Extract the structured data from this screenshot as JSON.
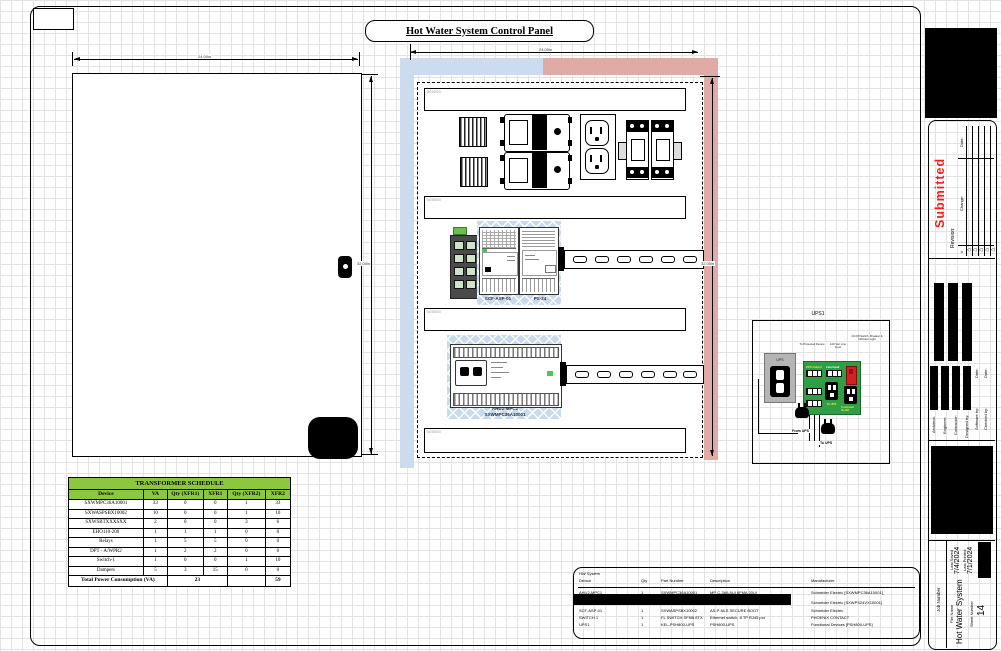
{
  "page_title": "Hot Water System Control Panel",
  "dimensions": {
    "door_width": "24.00in",
    "door_height": "32.00in",
    "panel_width": "24.00in",
    "panel_height": "32.00in"
  },
  "wireway_label": "000000",
  "backplane": {
    "scf_label": "SCF-ASP-01",
    "ps_label": "PS-24",
    "controller_name": "AHU2-MPC1",
    "controller_part": "SXWMPC36A10001"
  },
  "ups_detail": {
    "title": "UPS1",
    "ups_label": "UPS",
    "note_protected": "To Protected Device",
    "note_line": "120 Vac Line Input",
    "note_switch": "On/Off Switch, Breaker & Indicator Light",
    "board": {
      "ups_output": "UPS Output",
      "line_input": "Line Input",
      "to_ups_outlet": "To UPS",
      "computer_outlet": "Computer Outlet"
    },
    "cord_from_ups": "From UPS",
    "cord_to_ups": "To UPS"
  },
  "transformer_schedule": {
    "title": "TRANSFORMER SCHEDULE",
    "columns": [
      "Device",
      "VA",
      "Qty (XFR1)",
      "XFR1",
      "Qty (XFR2)",
      "XFR2"
    ],
    "rows": [
      [
        "SXWMPC36A10001",
        "33",
        "0",
        "0",
        "1",
        "33"
      ],
      [
        "SXWASPSBX10002",
        "10",
        "0",
        "0",
        "1",
        "10"
      ],
      [
        "SXWSBTXXXSXX",
        "2",
        "0",
        "0",
        "3",
        "6"
      ],
      [
        "EHO110-200",
        "1",
        "1",
        "1",
        "0",
        "0"
      ],
      [
        "Relays",
        "1",
        "5",
        "5",
        "0",
        "0"
      ],
      [
        "DPT - A/WPR2",
        "1",
        "2",
        "2",
        "0",
        "0"
      ],
      [
        "Switch-1",
        "1",
        "0",
        "0",
        "1",
        "10"
      ],
      [
        "Dampers",
        "5",
        "3",
        "15",
        "0",
        "0"
      ]
    ],
    "total_label": "Total Power Consumption (VA)",
    "total_xfr1": "23",
    "total_xfr2": "59"
  },
  "bom": {
    "system_label": "HW System",
    "columns": [
      "Device",
      "Qty",
      "Part Number",
      "Description",
      "Manufacturer"
    ],
    "rows": [
      [
        "AHU2-MPC1",
        "1",
        "SXWMPC36A10001",
        "MP-C-36A 8UI 8FMA 20UI",
        "Schneider Electric [SXWMPC36A10001]"
      ],
      [
        "PS-24",
        "1",
        "SXWPS24VX10001",
        "PSXXN POWER SUPPLY, 24VAC/DC",
        "Schneider Electric [SXWPS24VX10001]"
      ],
      [
        "SCF-ASP-01",
        "1",
        "SXWASPSBX10002",
        "AS-P-NLS SECURE BOOT",
        "Schneider Electric"
      ],
      [
        "SWITCH 1",
        "1",
        "FL SWITCH SFNB 8TX",
        "Ethernet switch, 8 TP RJ45 por",
        "PHOENIX CONTACT"
      ],
      [
        "UPS1",
        "1",
        "KEL-PSH800-UPS",
        "PSH800-UPS",
        "Functional Devices [PSH800-UPS]"
      ]
    ]
  },
  "title_block": {
    "stamp": "Submitted",
    "revision_label": "Revision:",
    "rev_hash": "#",
    "rev_change": "Change:",
    "rev_date": "Date:",
    "architect": "Architect:",
    "engineer": "Engineer:",
    "contractor": "Contractor:",
    "designed_by": "Designed by:",
    "software_by": "Software by:",
    "checked_by": "Checked by:",
    "date_label": "Date:",
    "job_number_label": "Job Number",
    "file_name_label": "File Name",
    "file_name": "Hot Water System",
    "sheet_number_label": "Sheet Number",
    "sheet_number": "14",
    "last_saved_label": "Last Saved",
    "last_saved": "7/4/2024",
    "last_printed_label": "Last Printed",
    "last_printed": "7/1/2024"
  },
  "colors": {
    "schedule_header": "#8dc63f",
    "hatch_blue": "#c7daee",
    "band_pink": "#dfaba4",
    "stamp_red": "#ff1a1a",
    "pcb_green": "#2f9e44"
  }
}
